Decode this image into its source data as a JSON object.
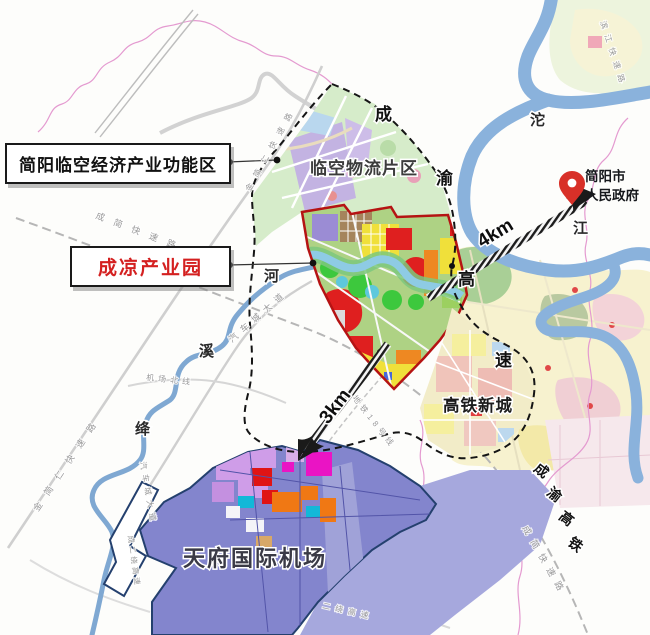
{
  "ann": {
    "zone": "简阳临空经济产业功能区",
    "park": "成凉产业园"
  },
  "poi": {
    "gov1": "简阳市",
    "gov2": "人民政府",
    "logistics": "临空物流片区",
    "hsr_town": "高铁新城",
    "airport": "天府国际机场"
  },
  "dist": {
    "gov": "4km",
    "airport": "3km"
  },
  "cy_expwy": [
    "成",
    "渝",
    "高",
    "速"
  ],
  "cy_hsr": [
    "成",
    "渝",
    "高",
    "铁"
  ],
  "riv": {
    "tuo": [
      "沱",
      "江"
    ],
    "jx": [
      "河",
      "溪",
      "绛"
    ]
  },
  "roads": {
    "cj_nw": "成简快速路",
    "cj_se": "成简快速路",
    "jjr_s": "金简仁快速路",
    "jjr_n": "金简仁快速路",
    "qcc": "汽车城大道",
    "qcc_w": "汽车城大道",
    "jcbx": "机场北线",
    "metro18": "地铁18号线",
    "er_se": "二绕高速",
    "er_w": "成二绕高速",
    "bj": "滨江快速路"
  },
  "colors": {
    "park_boundary": "#b51313",
    "zone_boundary": "#151515",
    "river": "#8ab2dc",
    "airport_fill": "#8385cd",
    "park_red_text": "#d42020",
    "pin_red": "#d83028"
  }
}
